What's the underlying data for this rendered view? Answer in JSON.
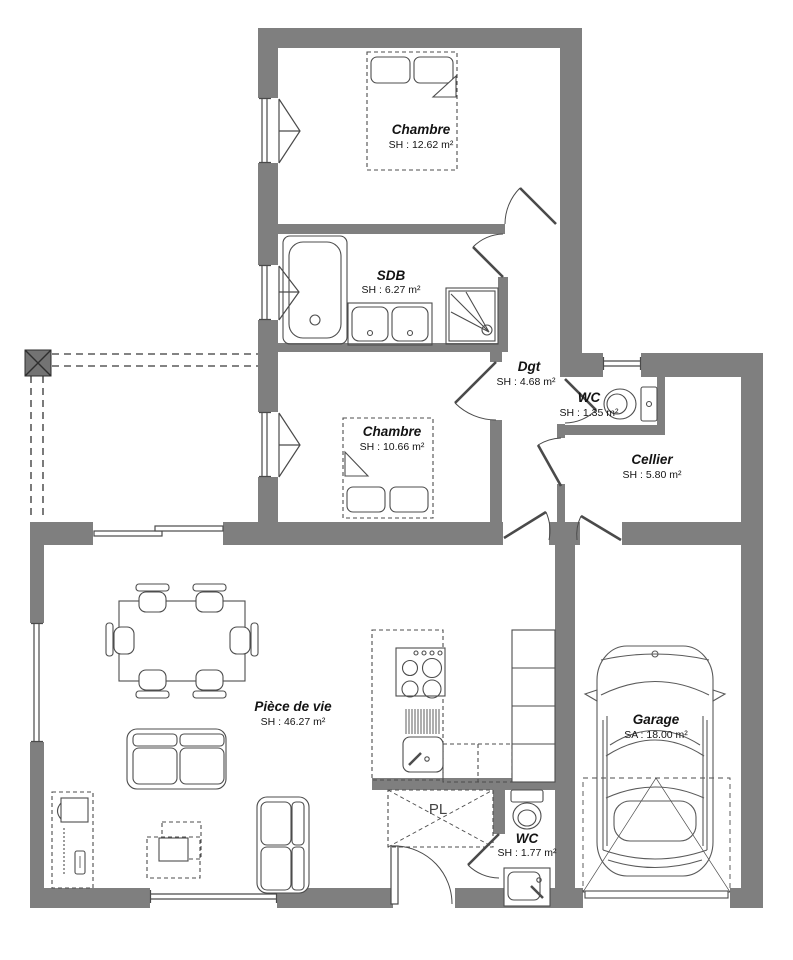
{
  "plan": {
    "title": "Plan de maison - rez-de-chaussée",
    "rooms": {
      "chambre1": {
        "name": "Chambre",
        "area": "SH : 12.62 m²"
      },
      "sdb": {
        "name": "SDB",
        "area": "SH : 6.27 m²"
      },
      "dgt": {
        "name": "Dgt",
        "area": "SH : 4.68 m²"
      },
      "wc1": {
        "name": "WC",
        "area": "SH : 1.35 m²"
      },
      "cellier": {
        "name": "Cellier",
        "area": "SH : 5.80 m²"
      },
      "chambre2": {
        "name": "Chambre",
        "area": "SH : 10.66 m²"
      },
      "piece_de_vie": {
        "name": "Pièce de vie",
        "area": "SH : 46.27 m²"
      },
      "garage": {
        "name": "Garage",
        "area": "SA : 18.00 m²"
      },
      "wc2": {
        "name": "WC",
        "area": "SH : 1.77 m²"
      },
      "pl": {
        "name": "PL"
      }
    },
    "colors": {
      "wall": "#7f7f7f",
      "line": "#4a4a4a",
      "fixture": "#4d4d4d",
      "dashed": "#5a5a5a",
      "car": "#5a5a5a",
      "text": "#141414",
      "post": "#737373",
      "background": "#ffffff"
    }
  }
}
